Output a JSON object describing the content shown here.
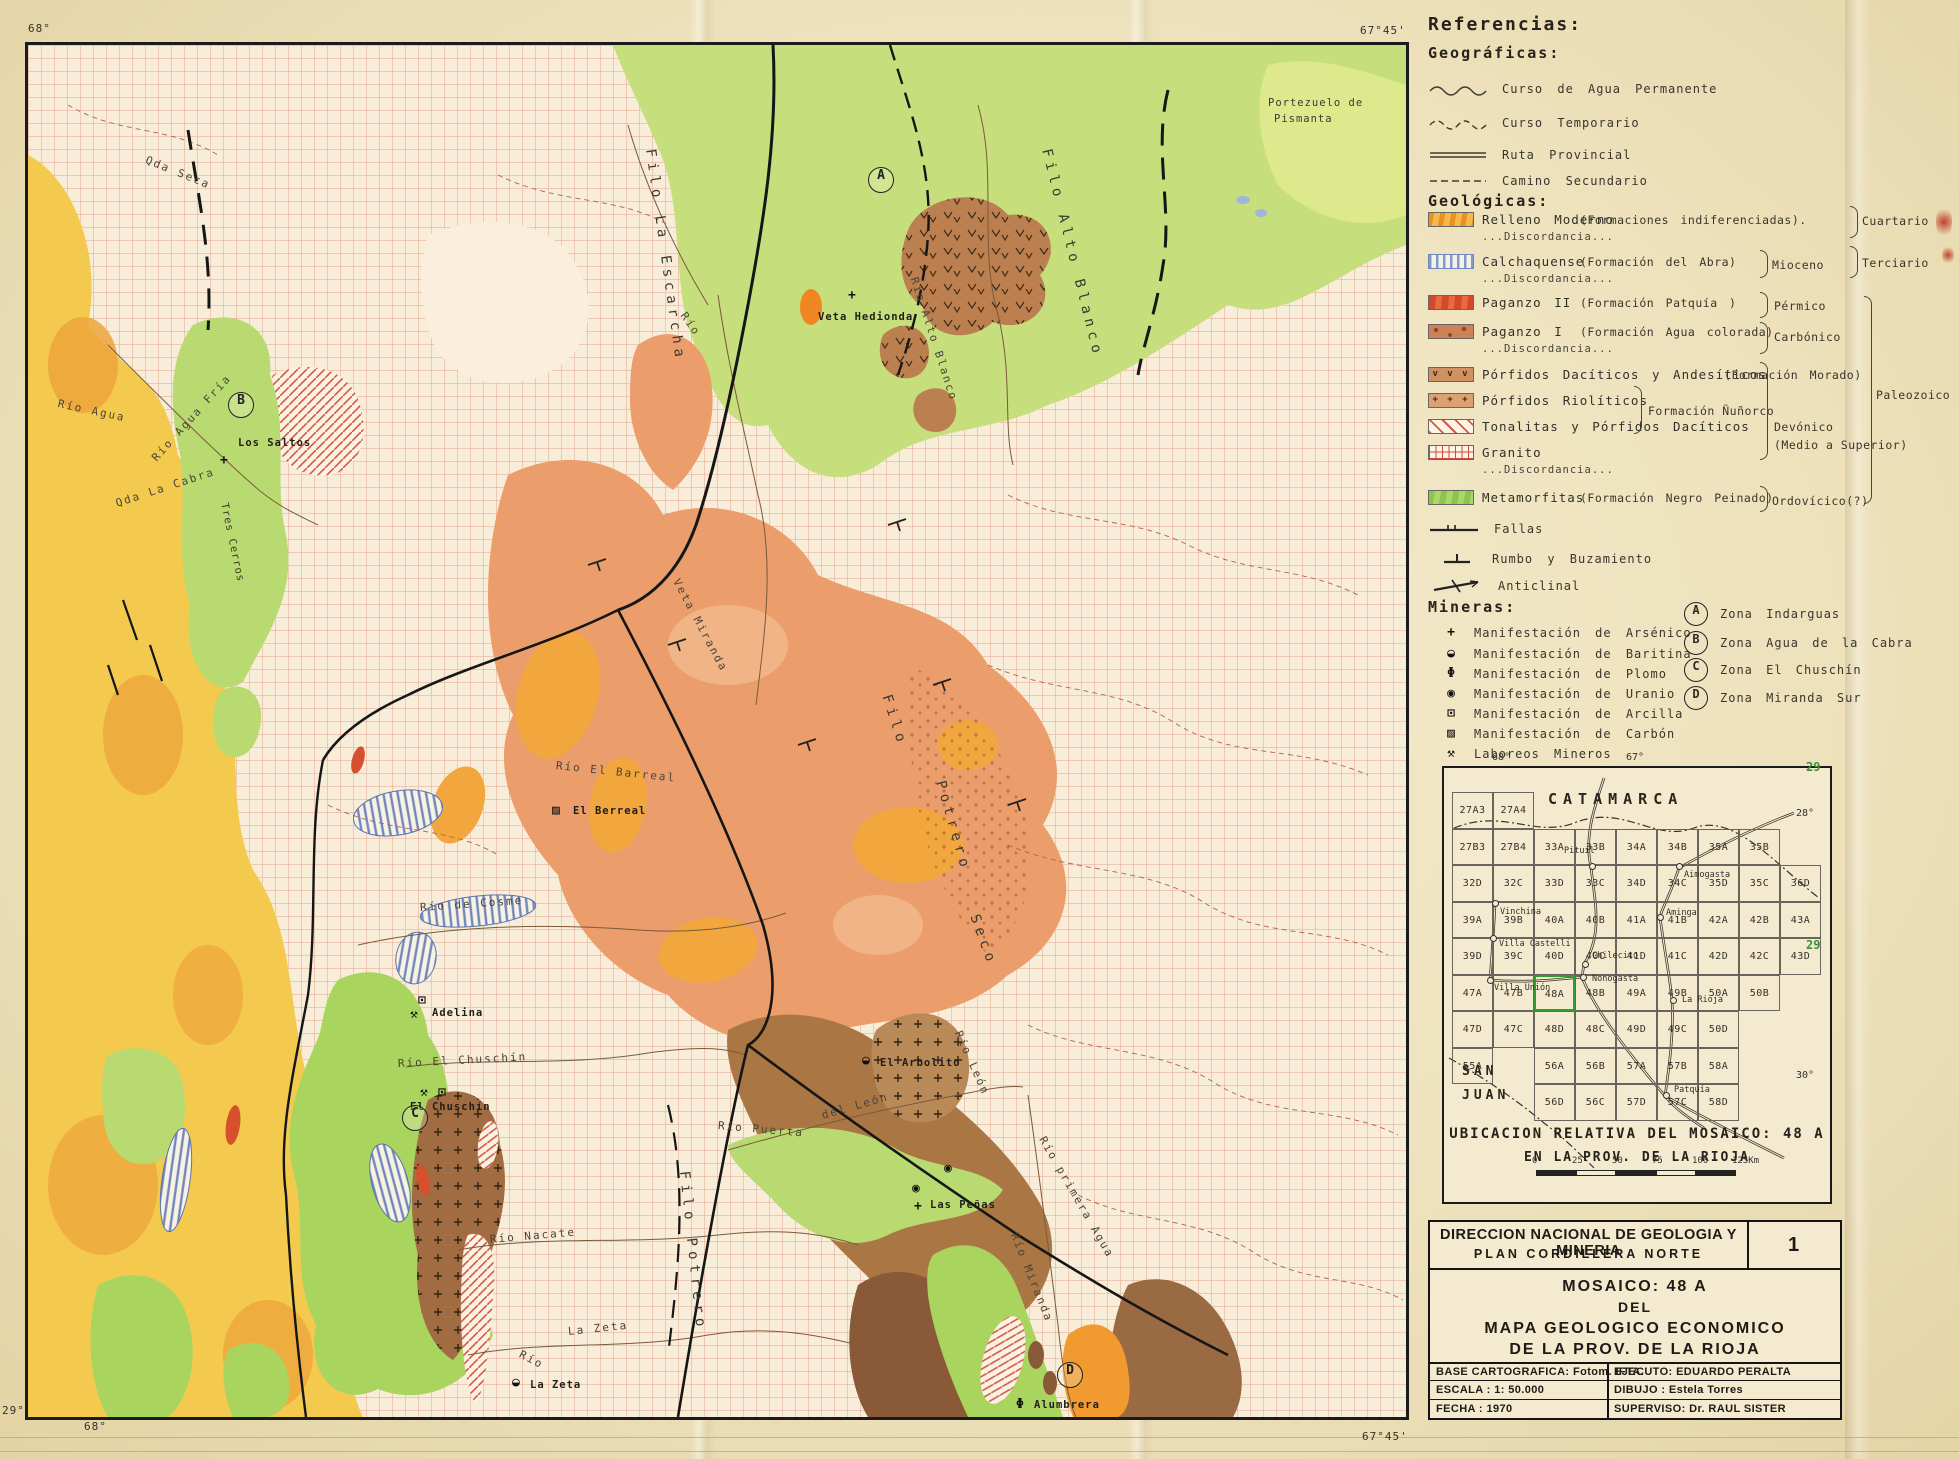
{
  "sheet": {
    "corners": {
      "top_left_lon": "68°",
      "top_right_lon": "67°45'",
      "bottom_left_lat": "29°22'",
      "bottom_left_lon": "68°",
      "bottom_right_lon": "67°45'"
    }
  },
  "map": {
    "labels": [
      {
        "t": "Qda Seca",
        "x": 118,
        "y": 108,
        "r": 22,
        "c": "river"
      },
      {
        "t": "Portezuelo de",
        "x": 1240,
        "y": 52,
        "r": 0,
        "c": "place"
      },
      {
        "t": "Pismanta",
        "x": 1246,
        "y": 68,
        "r": 0,
        "c": "place"
      },
      {
        "t": "Filo Alto Blanco",
        "x": 1018,
        "y": 96,
        "r": 76,
        "c": "ridge"
      },
      {
        "t": "Filo La Escarcha",
        "x": 622,
        "y": 96,
        "r": 82,
        "c": "ridge"
      },
      {
        "t": "Río",
        "x": 655,
        "y": 262,
        "r": 55,
        "c": "river"
      },
      {
        "t": "Río Alto Blanco",
        "x": 886,
        "y": 226,
        "r": 72,
        "c": "river"
      },
      {
        "t": "Veta Hedionda",
        "x": 790,
        "y": 266,
        "r": 0,
        "c": "mine"
      },
      {
        "g": "+",
        "x": 820,
        "y": 243
      },
      {
        "t": "Río Agua Fría",
        "x": 126,
        "y": 408,
        "r": -48,
        "c": "river"
      },
      {
        "t": "Los Saltos",
        "x": 210,
        "y": 392,
        "r": 0,
        "c": "mine"
      },
      {
        "g": "+",
        "x": 192,
        "y": 408
      },
      {
        "t": "Qda La Cabra",
        "x": 88,
        "y": 452,
        "r": -18,
        "c": "river"
      },
      {
        "t": "Río Agua",
        "x": 30,
        "y": 352,
        "r": 12,
        "c": "river"
      },
      {
        "t": "Tres Cerros",
        "x": 196,
        "y": 452,
        "r": 78,
        "c": "place"
      },
      {
        "t": "Veta Miranda",
        "x": 648,
        "y": 528,
        "r": 62,
        "c": "river"
      },
      {
        "t": "Filo",
        "x": 858,
        "y": 642,
        "r": 72,
        "c": "ridge"
      },
      {
        "t": "Potrero",
        "x": 912,
        "y": 728,
        "r": 74,
        "c": "ridge"
      },
      {
        "t": "Seco",
        "x": 946,
        "y": 862,
        "r": 70,
        "c": "ridge"
      },
      {
        "t": "Río El Barreal",
        "x": 528,
        "y": 714,
        "r": 6,
        "c": "river"
      },
      {
        "g": "▨",
        "x": 524,
        "y": 758
      },
      {
        "t": "El Berreal",
        "x": 545,
        "y": 760,
        "r": 0,
        "c": "mine"
      },
      {
        "t": "Río de Cosme",
        "x": 392,
        "y": 856,
        "r": -4,
        "c": "river"
      },
      {
        "g": "⊡",
        "x": 390,
        "y": 948
      },
      {
        "g": "⚒",
        "x": 382,
        "y": 962
      },
      {
        "t": "Adelina",
        "x": 404,
        "y": 962,
        "r": 0,
        "c": "mine"
      },
      {
        "t": "Río El Chuschín",
        "x": 370,
        "y": 1012,
        "r": -3,
        "c": "river"
      },
      {
        "g": "⚒",
        "x": 392,
        "y": 1040
      },
      {
        "g": "⊡",
        "x": 410,
        "y": 1040
      },
      {
        "t": "El Chuschín",
        "x": 382,
        "y": 1056,
        "r": 0,
        "c": "mine"
      },
      {
        "g": "◒",
        "x": 834,
        "y": 1008
      },
      {
        "t": "El Arbolito",
        "x": 852,
        "y": 1012,
        "r": 0,
        "c": "mine"
      },
      {
        "t": "Río León",
        "x": 930,
        "y": 980,
        "r": 66,
        "c": "river"
      },
      {
        "t": "Río Puerta",
        "x": 690,
        "y": 1074,
        "r": 5,
        "c": "river"
      },
      {
        "t": "del León",
        "x": 794,
        "y": 1064,
        "r": -16,
        "c": "river"
      },
      {
        "g": "◉",
        "x": 884,
        "y": 1136
      },
      {
        "g": "◉",
        "x": 916,
        "y": 1116
      },
      {
        "g": "+",
        "x": 886,
        "y": 1154
      },
      {
        "t": "Las Peñas",
        "x": 902,
        "y": 1154,
        "r": 0,
        "c": "mine"
      },
      {
        "t": "Río primera Agua",
        "x": 1014,
        "y": 1086,
        "r": 60,
        "c": "river"
      },
      {
        "t": "Filo Potrero",
        "x": 656,
        "y": 1118,
        "r": 84,
        "c": "ridge"
      },
      {
        "t": "Río Nacate",
        "x": 462,
        "y": 1188,
        "r": -5,
        "c": "river"
      },
      {
        "t": "La Zeta",
        "x": 540,
        "y": 1280,
        "r": -6,
        "c": "river"
      },
      {
        "t": "Río",
        "x": 492,
        "y": 1302,
        "r": 28,
        "c": "river"
      },
      {
        "g": "◒",
        "x": 484,
        "y": 1330
      },
      {
        "t": "La Zeta",
        "x": 502,
        "y": 1334,
        "r": 0,
        "c": "mine"
      },
      {
        "t": "Río Miranda",
        "x": 986,
        "y": 1182,
        "r": 68,
        "c": "river"
      },
      {
        "g": "Φ",
        "x": 988,
        "y": 1352
      },
      {
        "t": "Alumbrera",
        "x": 1006,
        "y": 1354,
        "r": 0,
        "c": "mine"
      }
    ],
    "zones": [
      {
        "letter": "A",
        "x": 852,
        "y": 134
      },
      {
        "letter": "B",
        "x": 212,
        "y": 359
      },
      {
        "letter": "C",
        "x": 386,
        "y": 1072
      },
      {
        "letter": "D",
        "x": 1041,
        "y": 1329
      }
    ]
  },
  "legend": {
    "title": "Referencias:",
    "geographic": {
      "title": "Geográficas:",
      "items": [
        {
          "label": "Curso de Agua Permanente",
          "symbol": "wavy-solid-line-icon"
        },
        {
          "label": "Curso Temporario",
          "symbol": "wavy-dashed-line-icon"
        },
        {
          "label": "Ruta Provincial",
          "symbol": "double-line-icon"
        },
        {
          "label": "Camino Secundario",
          "symbol": "dashed-line-icon"
        }
      ]
    },
    "geologic": {
      "title": "Geológicas:",
      "units": [
        {
          "name": "Relleno Moderno",
          "formation": "(Formaciones indiferenciadas).",
          "discord": "...Discordancia...",
          "era": "Cuartario",
          "swatch": "relleno"
        },
        {
          "name": "Calchaquense",
          "formation": "(Formación del Abra)",
          "discord": "...Discordancia...",
          "age": "Mioceno",
          "era": "Terciario",
          "swatch": "calchaquense"
        },
        {
          "name": "Paganzo II",
          "formation": "(Formación Patquía )",
          "age": "Pérmico",
          "swatch": "paganzo2"
        },
        {
          "name": "Paganzo I",
          "formation": "(Formación Agua colorada)",
          "discord": "...Discordancia...",
          "age": "Carbónico",
          "swatch": "paganzo1"
        },
        {
          "name": "Pórfidos Dacíticos y Andesíticos",
          "formation": "(Formación Morado)",
          "swatch": "dacitico"
        },
        {
          "name": "Pórfidos Riolíticos",
          "swatch": "riolitico"
        },
        {
          "name": "Tonalitas y Pórfidos Dacíticos",
          "swatch": "tonalita"
        },
        {
          "name": "Granito",
          "discord": "...Discordancia...",
          "swatch": "granito"
        },
        {
          "name": "Metamorfitas",
          "formation": "(Formación Negro Peinado)",
          "age": "Ordovícico(?)",
          "swatch": "metamorfita"
        }
      ],
      "nunorco": "Formación Ñuñorco",
      "devonico": "Devónico",
      "devonico_detail": "(Medio a Superior)",
      "paleozoico": "Paleozoico",
      "structures": [
        {
          "label": "Fallas",
          "symbol": "fault-line-icon"
        },
        {
          "label": "Rumbo y Buzamiento",
          "symbol": "strike-dip-icon"
        },
        {
          "label": "Anticlinal",
          "symbol": "anticline-icon"
        }
      ]
    },
    "mining": {
      "title": "Mineras:",
      "items": [
        {
          "glyph": "+",
          "label": "Manifestación de Arsénico",
          "icon": "arsenic-cross-icon"
        },
        {
          "glyph": "◒",
          "label": "Manifestación de Baritina",
          "icon": "barite-halfcircle-icon"
        },
        {
          "glyph": "Φ",
          "label": "Manifestación de Plomo",
          "icon": "lead-circle-bar-icon"
        },
        {
          "glyph": "◉",
          "label": "Manifestación de Uranio",
          "icon": "uranium-dot-circle-icon"
        },
        {
          "glyph": "⊡",
          "label": "Manifestación de Arcilla",
          "icon": "clay-box-icon"
        },
        {
          "glyph": "▨",
          "label": "Manifestación de Carbón",
          "icon": "coal-hatched-box-icon"
        },
        {
          "glyph": "⚒",
          "label": "Laboreos Mineros",
          "icon": "crossed-hammers-icon"
        }
      ]
    },
    "zones": [
      {
        "letter": "A",
        "label": "Zona  Indarguas"
      },
      {
        "letter": "B",
        "label": "Zona  Agua de la Cabra"
      },
      {
        "letter": "C",
        "label": "Zona  El Chuschín"
      },
      {
        "letter": "D",
        "label": "Zona  Miranda Sur"
      }
    ]
  },
  "index_map": {
    "title_line1": "UBICACION RELATIVA DEL MOSAICO: 48 A",
    "title_line2": "EN LA PROV. DE LA RIOJA",
    "highlight": "48A",
    "cells": [
      {
        "c": "27A3",
        "row": 0,
        "col": 0
      },
      {
        "c": "27A4",
        "row": 0,
        "col": 1
      },
      {
        "c": "27B3",
        "row": 1,
        "col": 0
      },
      {
        "c": "27B4",
        "row": 1,
        "col": 1
      },
      {
        "c": "33A",
        "row": 1,
        "col": 2
      },
      {
        "c": "33B",
        "row": 1,
        "col": 3
      },
      {
        "c": "34A",
        "row": 1,
        "col": 4
      },
      {
        "c": "34B",
        "row": 1,
        "col": 5
      },
      {
        "c": "35A",
        "row": 1,
        "col": 6
      },
      {
        "c": "35B",
        "row": 1,
        "col": 7
      },
      {
        "c": "32D",
        "row": 2,
        "col": 0
      },
      {
        "c": "32C",
        "row": 2,
        "col": 1
      },
      {
        "c": "33D",
        "row": 2,
        "col": 2
      },
      {
        "c": "33C",
        "row": 2,
        "col": 3
      },
      {
        "c": "34D",
        "row": 2,
        "col": 4
      },
      {
        "c": "34C",
        "row": 2,
        "col": 5
      },
      {
        "c": "35D",
        "row": 2,
        "col": 6
      },
      {
        "c": "35C",
        "row": 2,
        "col": 7
      },
      {
        "c": "36D",
        "row": 2,
        "col": 8
      },
      {
        "c": "39A",
        "row": 3,
        "col": 0
      },
      {
        "c": "39B",
        "row": 3,
        "col": 1
      },
      {
        "c": "40A",
        "row": 3,
        "col": 2
      },
      {
        "c": "40B",
        "row": 3,
        "col": 3
      },
      {
        "c": "41A",
        "row": 3,
        "col": 4
      },
      {
        "c": "41B",
        "row": 3,
        "col": 5
      },
      {
        "c": "42A",
        "row": 3,
        "col": 6
      },
      {
        "c": "42B",
        "row": 3,
        "col": 7
      },
      {
        "c": "43A",
        "row": 3,
        "col": 8
      },
      {
        "c": "39D",
        "row": 4,
        "col": 0
      },
      {
        "c": "39C",
        "row": 4,
        "col": 1
      },
      {
        "c": "40D",
        "row": 4,
        "col": 2
      },
      {
        "c": "40C",
        "row": 4,
        "col": 3
      },
      {
        "c": "41D",
        "row": 4,
        "col": 4
      },
      {
        "c": "41C",
        "row": 4,
        "col": 5
      },
      {
        "c": "42D",
        "row": 4,
        "col": 6
      },
      {
        "c": "42C",
        "row": 4,
        "col": 7
      },
      {
        "c": "43D",
        "row": 4,
        "col": 8
      },
      {
        "c": "47A",
        "row": 5,
        "col": 0
      },
      {
        "c": "47B",
        "row": 5,
        "col": 1
      },
      {
        "c": "48A",
        "row": 5,
        "col": 2
      },
      {
        "c": "48B",
        "row": 5,
        "col": 3
      },
      {
        "c": "49A",
        "row": 5,
        "col": 4
      },
      {
        "c": "49B",
        "row": 5,
        "col": 5
      },
      {
        "c": "50A",
        "row": 5,
        "col": 6
      },
      {
        "c": "50B",
        "row": 5,
        "col": 7
      },
      {
        "c": "47D",
        "row": 6,
        "col": 0
      },
      {
        "c": "47C",
        "row": 6,
        "col": 1
      },
      {
        "c": "48D",
        "row": 6,
        "col": 2
      },
      {
        "c": "48C",
        "row": 6,
        "col": 3
      },
      {
        "c": "49D",
        "row": 6,
        "col": 4
      },
      {
        "c": "49C",
        "row": 6,
        "col": 5
      },
      {
        "c": "50D",
        "row": 6,
        "col": 6
      },
      {
        "c": "55A",
        "row": 7,
        "col": 0
      },
      {
        "c": "56A",
        "row": 7,
        "col": 2
      },
      {
        "c": "56B",
        "row": 7,
        "col": 3
      },
      {
        "c": "57A",
        "row": 7,
        "col": 4
      },
      {
        "c": "57B",
        "row": 7,
        "col": 5
      },
      {
        "c": "58A",
        "row": 7,
        "col": 6
      },
      {
        "c": "56D",
        "row": 8,
        "col": 2
      },
      {
        "c": "56C",
        "row": 8,
        "col": 3
      },
      {
        "c": "57D",
        "row": 8,
        "col": 4
      },
      {
        "c": "57C",
        "row": 8,
        "col": 5
      },
      {
        "c": "58D",
        "row": 8,
        "col": 6
      }
    ],
    "cities": [
      {
        "n": "Pituil",
        "x": 120,
        "y": 78,
        "dx": 147,
        "dy": 97
      },
      {
        "n": "Aimogasta",
        "x": 240,
        "y": 102,
        "dx": 234,
        "dy": 97
      },
      {
        "n": "Vinchina",
        "x": 56,
        "y": 139,
        "dx": 50,
        "dy": 134
      },
      {
        "n": "Villa Castelli",
        "x": 55,
        "y": 171,
        "dx": 48,
        "dy": 169
      },
      {
        "n": "Villa Unión",
        "x": 50,
        "y": 215,
        "dx": 45,
        "dy": 211
      },
      {
        "n": "Chilecito",
        "x": 148,
        "y": 183,
        "dx": 140,
        "dy": 195
      },
      {
        "n": "Nonogasta",
        "x": 148,
        "y": 206,
        "dx": 138,
        "dy": 208
      },
      {
        "n": "Aminga",
        "x": 222,
        "y": 140,
        "dx": 215,
        "dy": 148
      },
      {
        "n": "La Rioja",
        "x": 238,
        "y": 227,
        "dx": 228,
        "dy": 231
      },
      {
        "n": "Patquía",
        "x": 230,
        "y": 317,
        "dx": 221,
        "dy": 326
      }
    ],
    "region_labels": [
      {
        "t": "CATAMARCA",
        "x": 104,
        "y": 22,
        "fs": 15,
        "ls": 6
      },
      {
        "t": "SAN",
        "x": 18,
        "y": 296,
        "fs": 13,
        "ls": 4
      },
      {
        "t": "JUAN",
        "x": 18,
        "y": 320,
        "fs": 13,
        "ls": 4
      }
    ],
    "annotations": [
      {
        "t": "68°",
        "x": 48,
        "y": -16
      },
      {
        "t": "67°",
        "x": 182,
        "y": -16
      },
      {
        "t": "28°",
        "x": 352,
        "y": 40
      },
      {
        "t": "30°",
        "x": 352,
        "y": 302
      },
      {
        "t": "29",
        "x": 362,
        "y": 170,
        "green": true
      },
      {
        "t": "29",
        "x": 362,
        "y": -8,
        "green": true
      }
    ],
    "scale_ticks": [
      "0",
      "25",
      "50",
      "75",
      "100",
      "125Km"
    ]
  },
  "title_block": {
    "org_line1": "DIRECCION NACIONAL DE GEOLOGIA Y MINERIA",
    "org_line2": "PLAN CORDILLERA NORTE",
    "sheet_no": "1",
    "title_line1": "MOSAICO: 48 A",
    "title_line2": "DEL",
    "title_line3": "MAPA GEOLOGICO ECONOMICO",
    "title_line4": "DE LA PROV. DE LA RIOJA",
    "base": "BASE CARTOGRAFICA: Fotom. IFTA.",
    "escala": "ESCALA : 1: 50.000",
    "fecha": "FECHA : 1970",
    "ejecuto": "EJECUTO: EDUARDO PERALTA",
    "dibujo": "DIBUJO : Estela Torres",
    "superviso": "SUPERVISO: Dr. RAUL SISTER"
  }
}
